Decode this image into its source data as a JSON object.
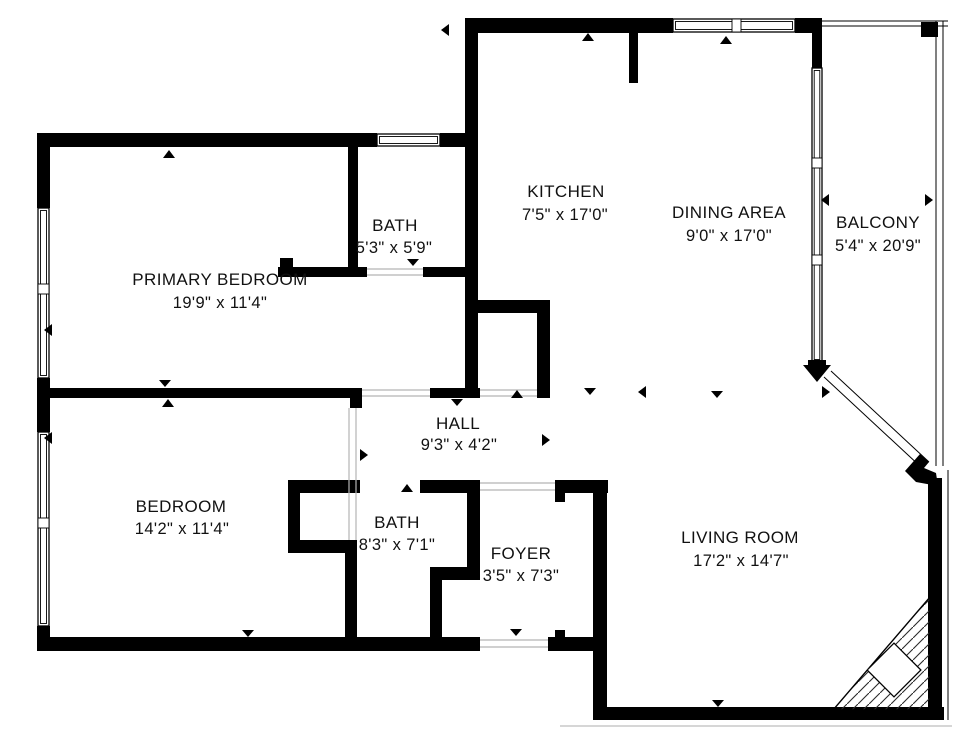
{
  "plan": {
    "type": "floor-plan",
    "background": "#ffffff",
    "colors": {
      "wall": "#000000",
      "text": "#111111",
      "threshold": "#b5b5b5",
      "shadow": "#c8c8c8"
    },
    "icons": {
      "door_marker": "small black triangle",
      "opening_arrow": "thick black arrow at diagonal balcony opening",
      "corner_hatch": "45-degree hatched corner with white diamond"
    }
  },
  "rooms": {
    "primary_bedroom": {
      "name": "PRIMARY BEDROOM",
      "dims": "19'9\" x 11'4\""
    },
    "bath_upper": {
      "name": "BATH",
      "dims": "5'3\" x 5'9\""
    },
    "kitchen": {
      "name": "KITCHEN",
      "dims": "7'5\" x 17'0\""
    },
    "dining_area": {
      "name": "DINING AREA",
      "dims": "9'0\" x 17'0\""
    },
    "balcony": {
      "name": "BALCONY",
      "dims": "5'4\" x 20'9\""
    },
    "hall": {
      "name": "HALL",
      "dims": "9'3\" x 4'2\""
    },
    "bedroom": {
      "name": "BEDROOM",
      "dims": "14'2\" x 11'4\""
    },
    "bath_lower": {
      "name": "BATH",
      "dims": "8'3\" x 7'1\""
    },
    "foyer": {
      "name": "FOYER",
      "dims": "3'5\" x 7'3\""
    },
    "living_room": {
      "name": "LIVING ROOM",
      "dims": "17'2\" x 14'7\""
    }
  }
}
